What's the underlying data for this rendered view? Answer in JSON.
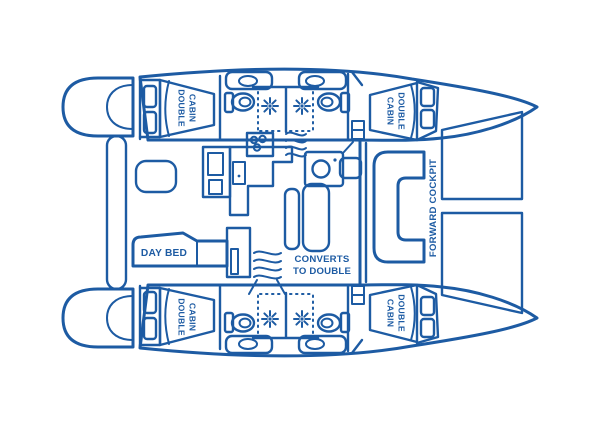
{
  "figure": {
    "kind": "catamaran-deck-plan",
    "background": "#ffffff",
    "line_color": "#1d5ba3"
  },
  "labels": {
    "double_cabin": {
      "line1": "DOUBLE",
      "line2": "CABIN"
    },
    "day_bed": "DAY BED",
    "converts": {
      "line1": "CONVERTS",
      "line2": "TO DOUBLE"
    },
    "forward_cockpit": "FORWARD COCKPIT"
  },
  "label_instances": {
    "double_cabin_count": 4
  },
  "icons": {
    "shower-spray-icon": "starburst",
    "toilet-icon": "oval bowl with cistern",
    "sink-icon": "oval basin",
    "stove-icon": "three-burner cooktop",
    "trampoline-net-icon": "diamond crosshatch",
    "steps-icon": "wavy companionway lines"
  }
}
